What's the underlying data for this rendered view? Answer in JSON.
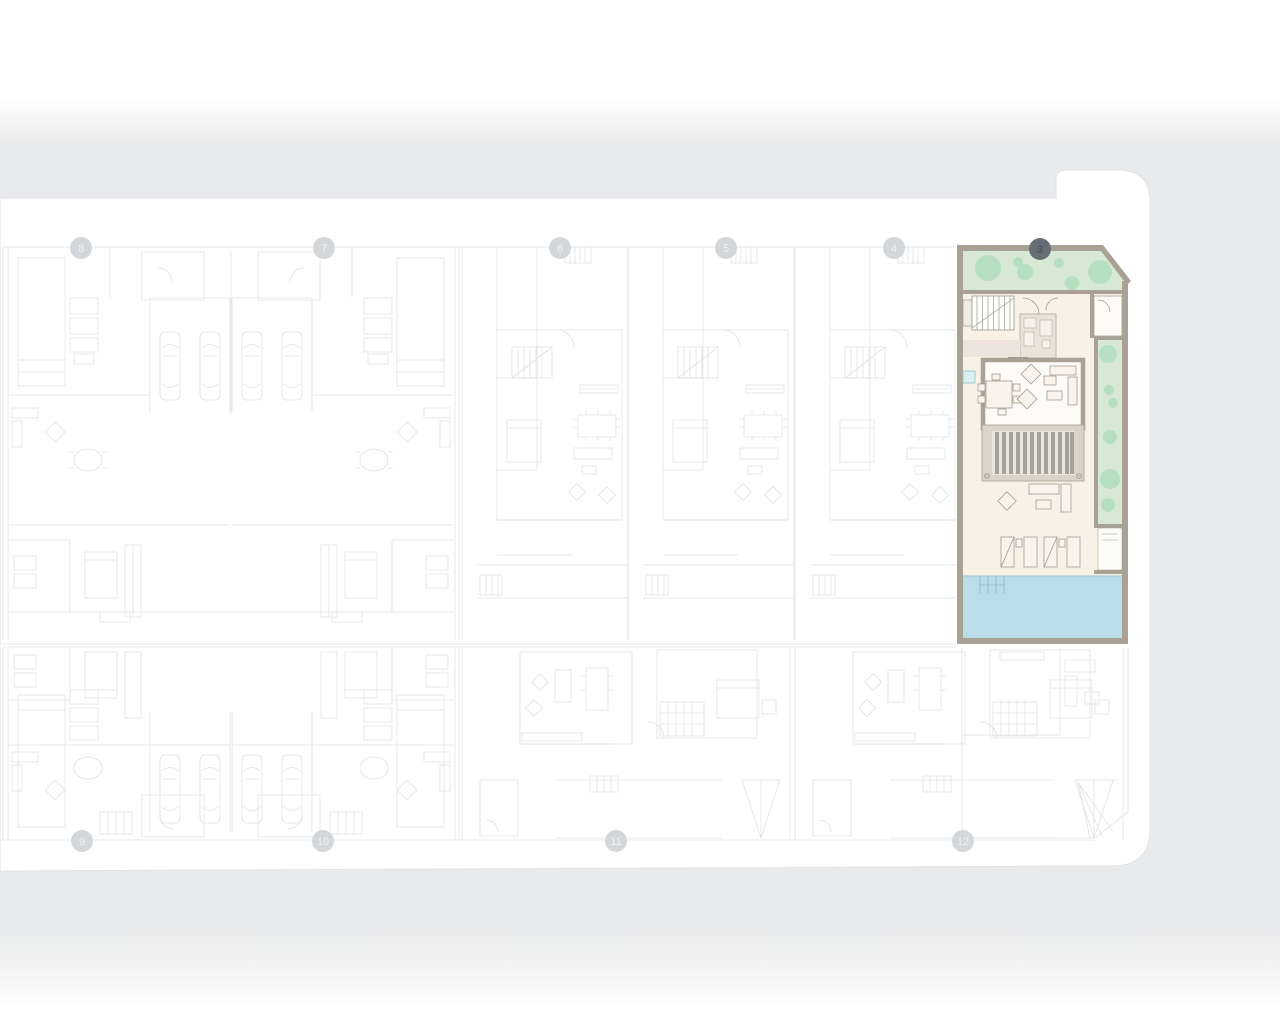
{
  "plan": {
    "highlighted_unit": {
      "number": "3"
    },
    "top_row_units": [
      {
        "number": "8"
      },
      {
        "number": "7"
      },
      {
        "number": "6"
      },
      {
        "number": "5"
      },
      {
        "number": "4"
      }
    ],
    "bottom_row_units": [
      {
        "number": "9"
      },
      {
        "number": "10"
      },
      {
        "number": "11"
      },
      {
        "number": "12"
      }
    ]
  },
  "colors": {
    "surround-gray": "#e9eaeb",
    "site-white": "#ffffff",
    "site-edge": "#e2e3e4",
    "plan-line": "#c3cad2",
    "badge-fill": "#d3d7da",
    "badge-text": "#eef0f2",
    "badge-active-fill": "#676d73",
    "badge-active-text": "#4f5459",
    "wall": "#a9a294",
    "wall-light": "#c3bcae",
    "cream": "#f7f1e6",
    "room-white": "#fcfbf7",
    "green": "#d7e9d4",
    "tree": "#aeddbb",
    "pool": "#b9dde9",
    "pool-line": "#8fb9c5",
    "slat": "#a3a39b",
    "slat-frame": "#d9d4c7",
    "slat-bed": "#eae6dc",
    "blush": "#efe3dd",
    "kitchen-beige": "#eae3d7",
    "teal": "#dcefee",
    "teal-edge": "#8fc2c8",
    "furn-line": "#a39c90",
    "detail-line": "#9b9b95"
  }
}
